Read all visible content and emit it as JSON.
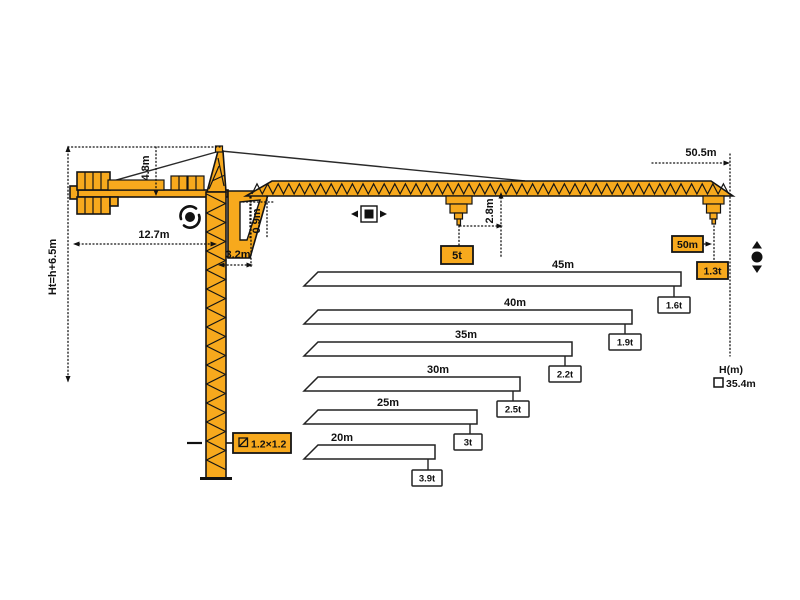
{
  "diagram": {
    "dimensions": {
      "hook_height_formula": "Ht=h+6.5m",
      "counter_jib_length": "12.7m",
      "tower_head_height": "4.8m",
      "jib_root_offset": "3.2m",
      "jib_section_height": "0.9m",
      "tip_hook_clearance": "2.8m",
      "max_jib_length": "50.5m"
    },
    "max_capacity": "5t",
    "tip_load": {
      "radius": "50m",
      "capacity": "1.3t"
    },
    "free_standing_height": {
      "label": "H(m)",
      "value": "35.4m"
    },
    "mast_section": "1.2×1.2",
    "jib_options": [
      {
        "length": "45m",
        "tip_capacity": "1.6t"
      },
      {
        "length": "40m",
        "tip_capacity": "1.9t"
      },
      {
        "length": "35m",
        "tip_capacity": "2.2t"
      },
      {
        "length": "30m",
        "tip_capacity": "2.5t"
      },
      {
        "length": "25m",
        "tip_capacity": "3t"
      },
      {
        "length": "20m",
        "tip_capacity": "3.9t"
      }
    ],
    "icons": {
      "slewing": "slewing-rotation-icon",
      "trolley": "trolley-travel-icon",
      "hoisting": "hoisting-up-down-icon",
      "section": "square-section-icon",
      "height_marker": "height-checkbox-icon"
    },
    "colors": {
      "crane_yellow": "#F7A91D",
      "outline": "#151515",
      "background": "#FFFFFF"
    }
  },
  "chart_data": {
    "type": "bar",
    "title": "Jib length vs. tip capacity",
    "categories": [
      "45m",
      "40m",
      "35m",
      "30m",
      "25m",
      "20m"
    ],
    "values": [
      1.6,
      1.9,
      2.2,
      2.5,
      3.0,
      3.9
    ],
    "xlabel": "jib length",
    "ylabel": "tip capacity (t)",
    "notes": "bars drawn as jib silhouettes; capacity tag at bar tip"
  }
}
